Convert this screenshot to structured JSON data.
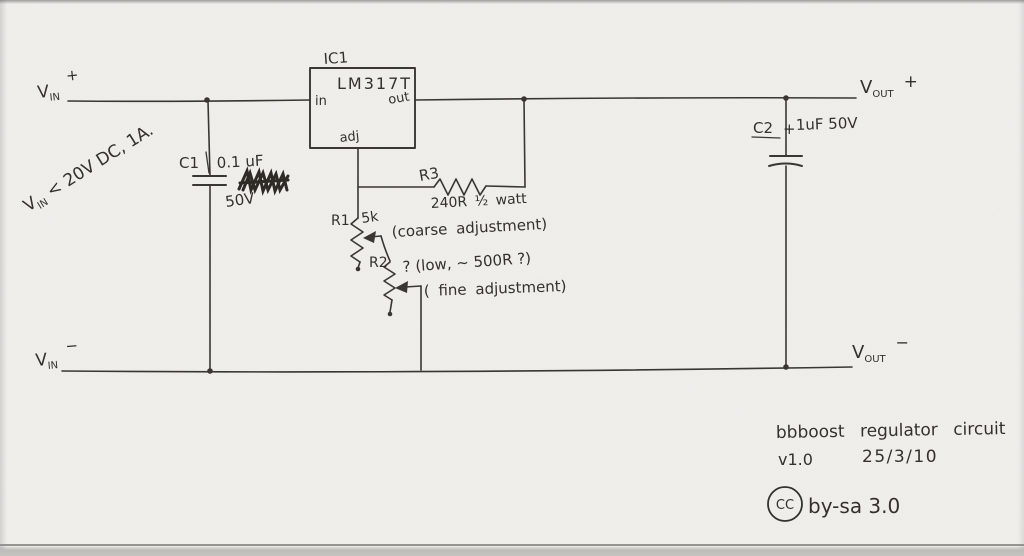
{
  "terminals": {
    "vin_plus": {
      "base": "V",
      "sub": "IN",
      "sign": "+"
    },
    "vin_minus": {
      "base": "V",
      "sub": "IN",
      "sign": "−"
    },
    "vout_plus": {
      "base": "V",
      "sub": "OUT",
      "sign": "+"
    },
    "vout_minus": {
      "base": "V",
      "sub": "OUT",
      "sign": "−"
    }
  },
  "input_note": {
    "base": "V",
    "sub": "IN",
    "rest": " < 20V DC, 1A."
  },
  "components": {
    "ic1": {
      "ref": "IC1",
      "part": "LM317T",
      "pin_in": "in",
      "pin_out": "out",
      "pin_adj": "adj"
    },
    "c1": {
      "ref": "C1",
      "value": "0.1 uF",
      "voltage": "50V"
    },
    "c2": {
      "ref": "C2",
      "polarity": "+",
      "value": "1uF 50V"
    },
    "r3": {
      "ref": "R3",
      "value": "240R ½ watt"
    },
    "r1": {
      "ref": "R1",
      "value": "5k",
      "annotation": "(coarse adjustment)"
    },
    "r2": {
      "ref": "R2",
      "value_note": "? (low, ~ 500R ?)",
      "annotation": "( fine adjustment)"
    }
  },
  "title_block": {
    "title": "bbboost regulator circuit",
    "version": "v1.0",
    "date": "25/3/10"
  },
  "license": {
    "badge": "CC",
    "text": "by-sa 3.0"
  },
  "colors": {
    "paper": "#f1f0ed",
    "ink": "#3a3732",
    "text_ink": "#34312c"
  }
}
